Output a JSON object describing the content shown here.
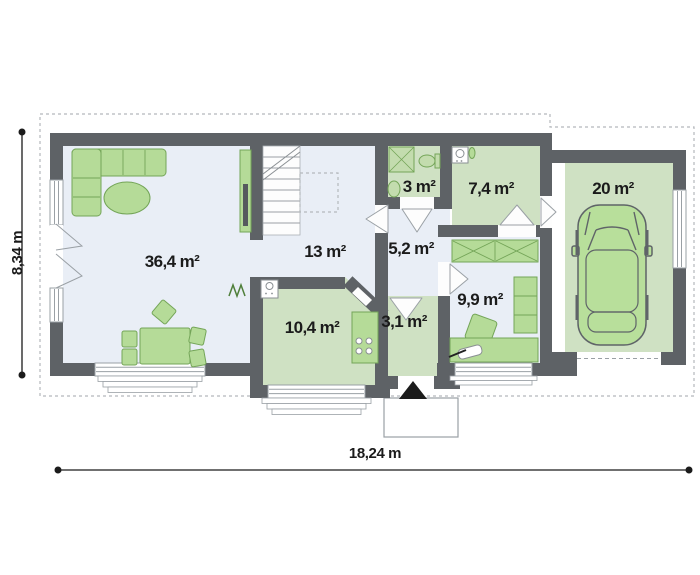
{
  "plan": {
    "rooms": [
      {
        "name": "living-room",
        "area_label": "36,4 m²"
      },
      {
        "name": "hall-stairs",
        "area_label": "13 m²"
      },
      {
        "name": "bathroom",
        "area_label": "3 m²"
      },
      {
        "name": "utility-room",
        "area_label": "7,4 m²"
      },
      {
        "name": "garage",
        "area_label": "20 m²"
      },
      {
        "name": "corridor",
        "area_label": "5,2 m²"
      },
      {
        "name": "bedroom",
        "area_label": "9,9 m²"
      },
      {
        "name": "kitchen",
        "area_label": "10,4 m²"
      },
      {
        "name": "vestibule",
        "area_label": "3,1 m²"
      }
    ],
    "dimensions": {
      "width_label": "18,24 m",
      "height_label": "8,34 m"
    },
    "colors": {
      "wall": "#5e6266",
      "room_green": "#cfe1c3",
      "floor_light": "#e9eef6",
      "furniture_green": "#b5db98",
      "furniture_outline": "#74a558",
      "dashed_outline": "#b4b8bc",
      "text": "#1b1b1b"
    }
  }
}
